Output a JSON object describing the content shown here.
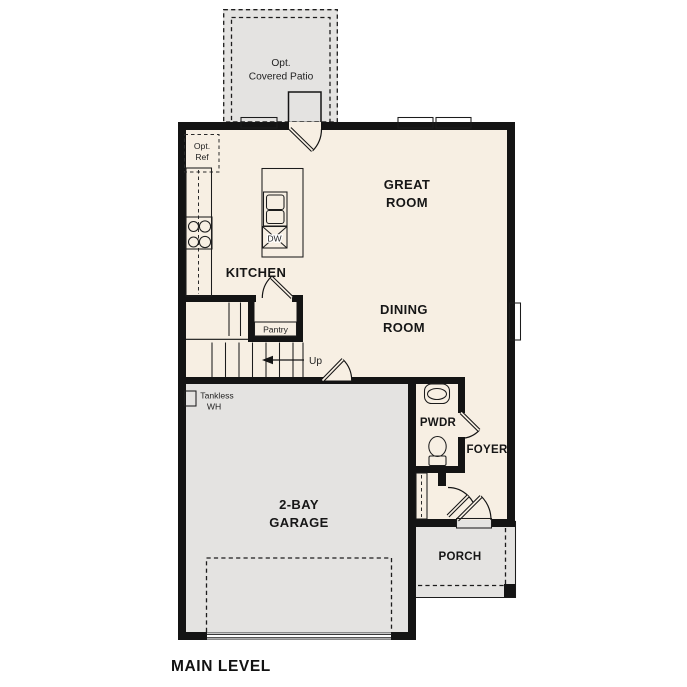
{
  "title": "MAIN LEVEL",
  "colors": {
    "wall": "#141414",
    "floor": "#f7efe3",
    "outdoor": "#e4e3e1",
    "counter": "#d3c5a8",
    "shelf": "#cfc0a3",
    "closet_rod": "#c6b190",
    "sink": "#b3cbe8"
  },
  "labels": {
    "patio": {
      "line1": "Opt.",
      "line2": "Covered Patio"
    },
    "opt_ref": {
      "line1": "Opt.",
      "line2": "Ref"
    },
    "great_room": {
      "line1": "GREAT",
      "line2": "ROOM"
    },
    "dining_room": {
      "line1": "DINING",
      "line2": "ROOM"
    },
    "kitchen": "KITCHEN",
    "pantry": "Pantry",
    "dishwasher": "DW",
    "stairs_up": "Up",
    "tankless": {
      "line1": "Tankless",
      "line2": "WH"
    },
    "garage": {
      "line1": "2-BAY",
      "line2": "GARAGE"
    },
    "powder": "PWDR",
    "foyer": "FOYER",
    "porch": "PORCH",
    "main_level": "MAIN LEVEL"
  }
}
